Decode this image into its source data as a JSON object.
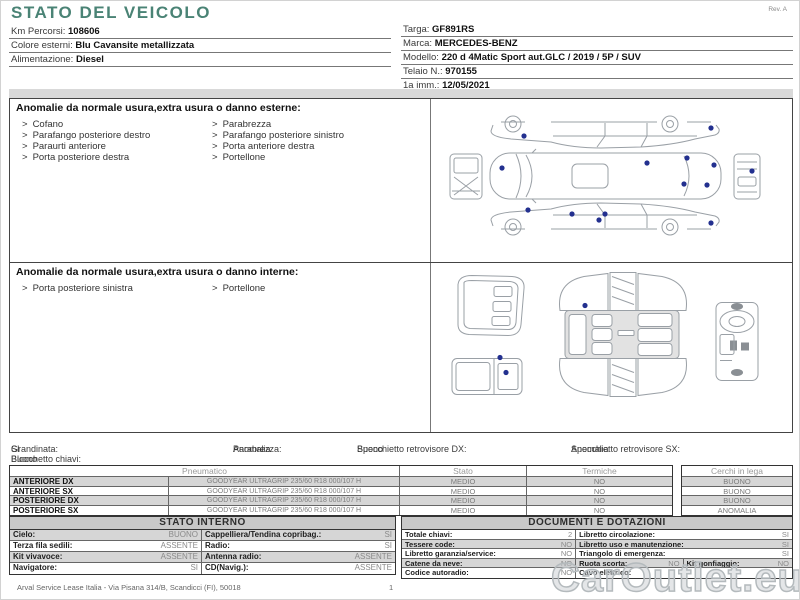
{
  "ui": {
    "bullet": ">"
  },
  "header": {
    "title": "STATO DEL VEICOLO",
    "revision": "Rev. A",
    "info_left": [
      {
        "label": "Km Percorsi:",
        "value": "108606"
      },
      {
        "label": "Colore esterni:",
        "value": "Blu Cavansite metallizzata"
      },
      {
        "label": "Alimentazione:",
        "value": "Diesel"
      }
    ],
    "info_right": [
      {
        "label": "Targa:",
        "value": "GF891RS"
      },
      {
        "label": "Marca:",
        "value": "MERCEDES-BENZ"
      },
      {
        "label": "Modello:",
        "value": "220 d 4Matic Sport aut.GLC / 2019 / 5P / SUV"
      },
      {
        "label": "Telaio N.:",
        "value": "970155"
      },
      {
        "label": "1a imm.:",
        "value": "12/05/2021"
      }
    ]
  },
  "exterior": {
    "title": "Anomalie da normale usura,extra usura o danno esterne:",
    "left_items": [
      "Cofano",
      "Parafango posteriore destro",
      "Paraurti anteriore",
      "Porta posteriore destra"
    ],
    "right_items": [
      "Parabrezza",
      "Parafango posteriore sinistro",
      "Porta anteriore destra",
      "Portellone"
    ]
  },
  "interior": {
    "title": "Anomalie da normale usura,extra usura o danno interne:",
    "left_items": [
      "Porta posteriore sinistra"
    ],
    "right_items": [
      "Portellone"
    ]
  },
  "summary": {
    "items": [
      {
        "label": "Grandinata:",
        "value": "SI"
      },
      {
        "label": "Parabrezza:",
        "value": "Anomalia"
      },
      {
        "label": "Specchietto retrovisore DX:",
        "value": "Buono"
      },
      {
        "label": "Specchietto retrovisore SX:",
        "value": "Anomalia"
      },
      {
        "label": "Blocchetto chiavi:",
        "value": "Buono"
      }
    ]
  },
  "tyres": {
    "headers": {
      "pneumatico": "Pneumatico",
      "stato": "Stato",
      "termiche": "Termiche",
      "cerchi": "Cerchi in lega"
    },
    "rows": [
      {
        "position": "ANTERIORE DX",
        "spec": "GOODYEAR ULTRAGRIP 235/60 R18 000/107 H",
        "stato": "MEDIO",
        "termiche": "NO",
        "cerchi": "BUONO"
      },
      {
        "position": "ANTERIORE SX",
        "spec": "GOODYEAR ULTRAGRIP 235/60 R18 000/107 H",
        "stato": "MEDIO",
        "termiche": "NO",
        "cerchi": "BUONO"
      },
      {
        "position": "POSTERIORE DX",
        "spec": "GOODYEAR ULTRAGRIP 235/60 R18 000/107 H",
        "stato": "MEDIO",
        "termiche": "NO",
        "cerchi": "BUONO"
      },
      {
        "position": "POSTERIORE SX",
        "spec": "GOODYEAR ULTRAGRIP 235/60 R18 000/107 H",
        "stato": "MEDIO",
        "termiche": "NO",
        "cerchi": "ANOMALIA"
      }
    ]
  },
  "stato_interno": {
    "title": "STATO INTERNO",
    "rows": [
      {
        "l1": "Cielo:",
        "v1": "BUONO",
        "l2": "Cappelliera/Tendina copribag.:",
        "v2": "SI"
      },
      {
        "l1": "Terza fila sedili:",
        "v1": "ASSENTE",
        "l2": "Radio:",
        "v2": "SI"
      },
      {
        "l1": "Kit vivavoce:",
        "v1": "ASSENTE",
        "l2": "Antenna radio:",
        "v2": "ASSENTE"
      },
      {
        "l1": "Navigatore:",
        "v1": "SI",
        "l2": "CD(Navig.):",
        "v2": "ASSENTE"
      }
    ]
  },
  "documenti": {
    "title": "DOCUMENTI E DOTAZIONI",
    "rows": [
      {
        "l1": "Totale chiavi:",
        "v1": "2",
        "l2": "Libretto circolazione:",
        "v2": "SI"
      },
      {
        "l1": "Tessere code:",
        "v1": "NO",
        "l2": "Libretto uso e manutenzione:",
        "v2": "SI"
      },
      {
        "l1": "Libretto garanzia/service:",
        "v1": "NO",
        "l2": "Triangolo di emergenza:",
        "v2": "SI"
      },
      {
        "l1": "Catene da neve:",
        "v1": "NO",
        "l2": "Ruota scorta:",
        "v2": "NO",
        "l3": "Kit gonfiaggio:",
        "v3": "NO"
      },
      {
        "l1": "Codice autoradio:",
        "v1": "NO",
        "l2": "Cavo elettrico:",
        "v2": ""
      }
    ]
  },
  "footer": {
    "company": "Arval Service Lease Italia - Via Pisana 314/B, Scandicci (FI), 50018",
    "page_number": "1",
    "watermark": "CarOutlet.eu"
  }
}
